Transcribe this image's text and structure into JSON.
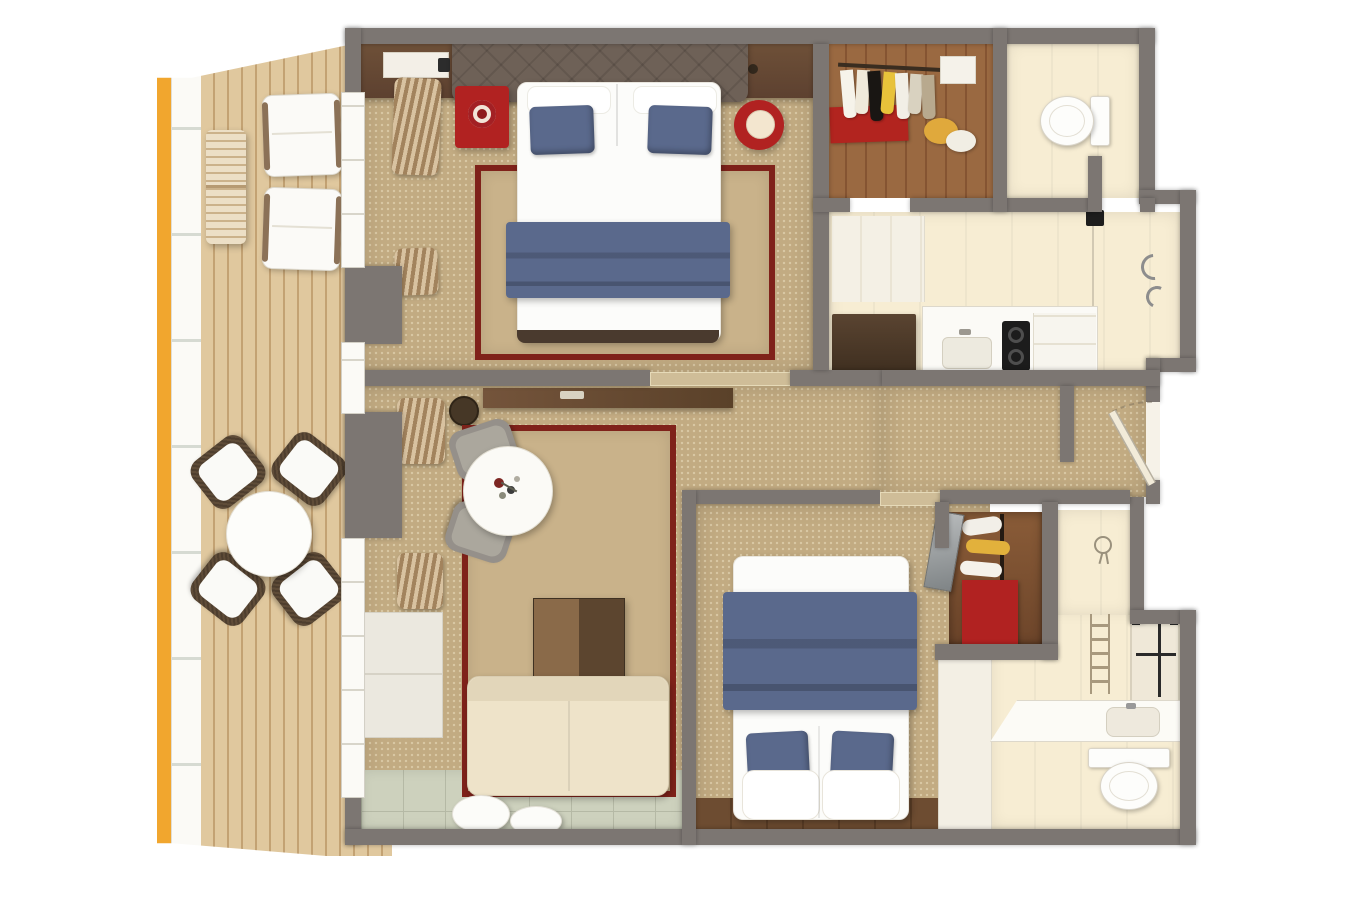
{
  "scene": {
    "kind": "3d-floor-plan-render",
    "view": "top-down",
    "description": "Photorealistic top-down 3D floor plan of a two-bedroom suite with a long side balcony, two bathrooms, walk-in closet, kitchenette niche and living room"
  },
  "palette": {
    "wall": "#7c7672",
    "carpet": "#c2ab82",
    "carpet-speck": "#d9c8a4",
    "rug": "#c9b28a",
    "rug-border": "#7f221a",
    "deck": "#e0c89e",
    "deck-line": "#c3a273",
    "railing": "#fbfaf6",
    "hull-yellow": "#f1a62e",
    "navy": "#5a698c",
    "navy-dark": "#49587a",
    "red": "#b12221",
    "red-dark": "#8e1a1c",
    "wood-dark": "#5d4532",
    "wood-mid": "#74543b",
    "wood-floor": "#6d4c31",
    "wood-floor-dark": "#5b3e26",
    "closet-wood": "#9a6941",
    "cream": "#f7edd3",
    "counter": "#fcfbf6",
    "sofa": "#eee3c9",
    "tile": "#cdd1bd",
    "tile-line": "#b5b9a5",
    "gray-chair": "#95908a",
    "headboard": "#6e6157",
    "white": "#ffffff",
    "frame-black": "#2a2a2a"
  },
  "rooms": [
    {
      "id": "balcony",
      "floor": "wood-deck",
      "items": [
        "hull-accent-stripe",
        "railing",
        "awning-top",
        "awning-bottom",
        "lounge-chair",
        "lounge-chair",
        "slatted-table",
        "patio-dining-table",
        "patio-chair",
        "patio-chair",
        "patio-chair",
        "patio-chair"
      ]
    },
    {
      "id": "master-bedroom",
      "floor": "carpet",
      "items": [
        "console-shelf",
        "ceiling-vent-panel",
        "headboard",
        "double-bed",
        "accent-pillow",
        "accent-pillow",
        "bed-runner",
        "area-rug",
        "red-nightstand",
        "alarm-clock",
        "red-side-table",
        "curtains",
        "curtains",
        "balcony-door"
      ]
    },
    {
      "id": "walk-in-closet",
      "floor": "wood",
      "items": [
        "clothes-rail",
        "garments",
        "red-floor-mat",
        "bags",
        "shelf-box"
      ]
    },
    {
      "id": "toilet-room",
      "floor": "stone",
      "items": [
        "wall-hung-toilet"
      ]
    },
    {
      "id": "bathroom-kitchenette",
      "floor": "stone",
      "items": [
        "tall-dark-cabinet",
        "counter",
        "sink",
        "two-burner-cooktop",
        "appliance-cabinet",
        "glass-partition",
        "wall-fixture",
        "shower-handles"
      ]
    },
    {
      "id": "hallway",
      "floor": "carpet",
      "items": [
        "entry-door",
        "door-swing-arc"
      ]
    },
    {
      "id": "living-room",
      "floor": "carpet",
      "items": [
        "sideboard",
        "wooden-stool",
        "round-dining-table",
        "flower-centerpiece",
        "dining-chair",
        "dining-chair",
        "area-rug",
        "coffee-table",
        "sofa",
        "pouf",
        "pouf",
        "towel-shelf",
        "towel-shelf",
        "side-cabinet",
        "balcony-door",
        "tile-floor-strip"
      ]
    },
    {
      "id": "second-bedroom",
      "floor": "carpet-and-wood",
      "items": [
        "double-bed",
        "accent-pillow",
        "accent-pillow",
        "bed-runner",
        "wardrobe",
        "mirror-door",
        "red-cabinet",
        "shoe-shelves",
        "vanity-slab"
      ]
    },
    {
      "id": "second-bathroom",
      "floor": "stone",
      "items": [
        "shower-enclosure",
        "towel-ladder",
        "vanity-counter",
        "sink",
        "toilet",
        "shower-head"
      ]
    }
  ]
}
